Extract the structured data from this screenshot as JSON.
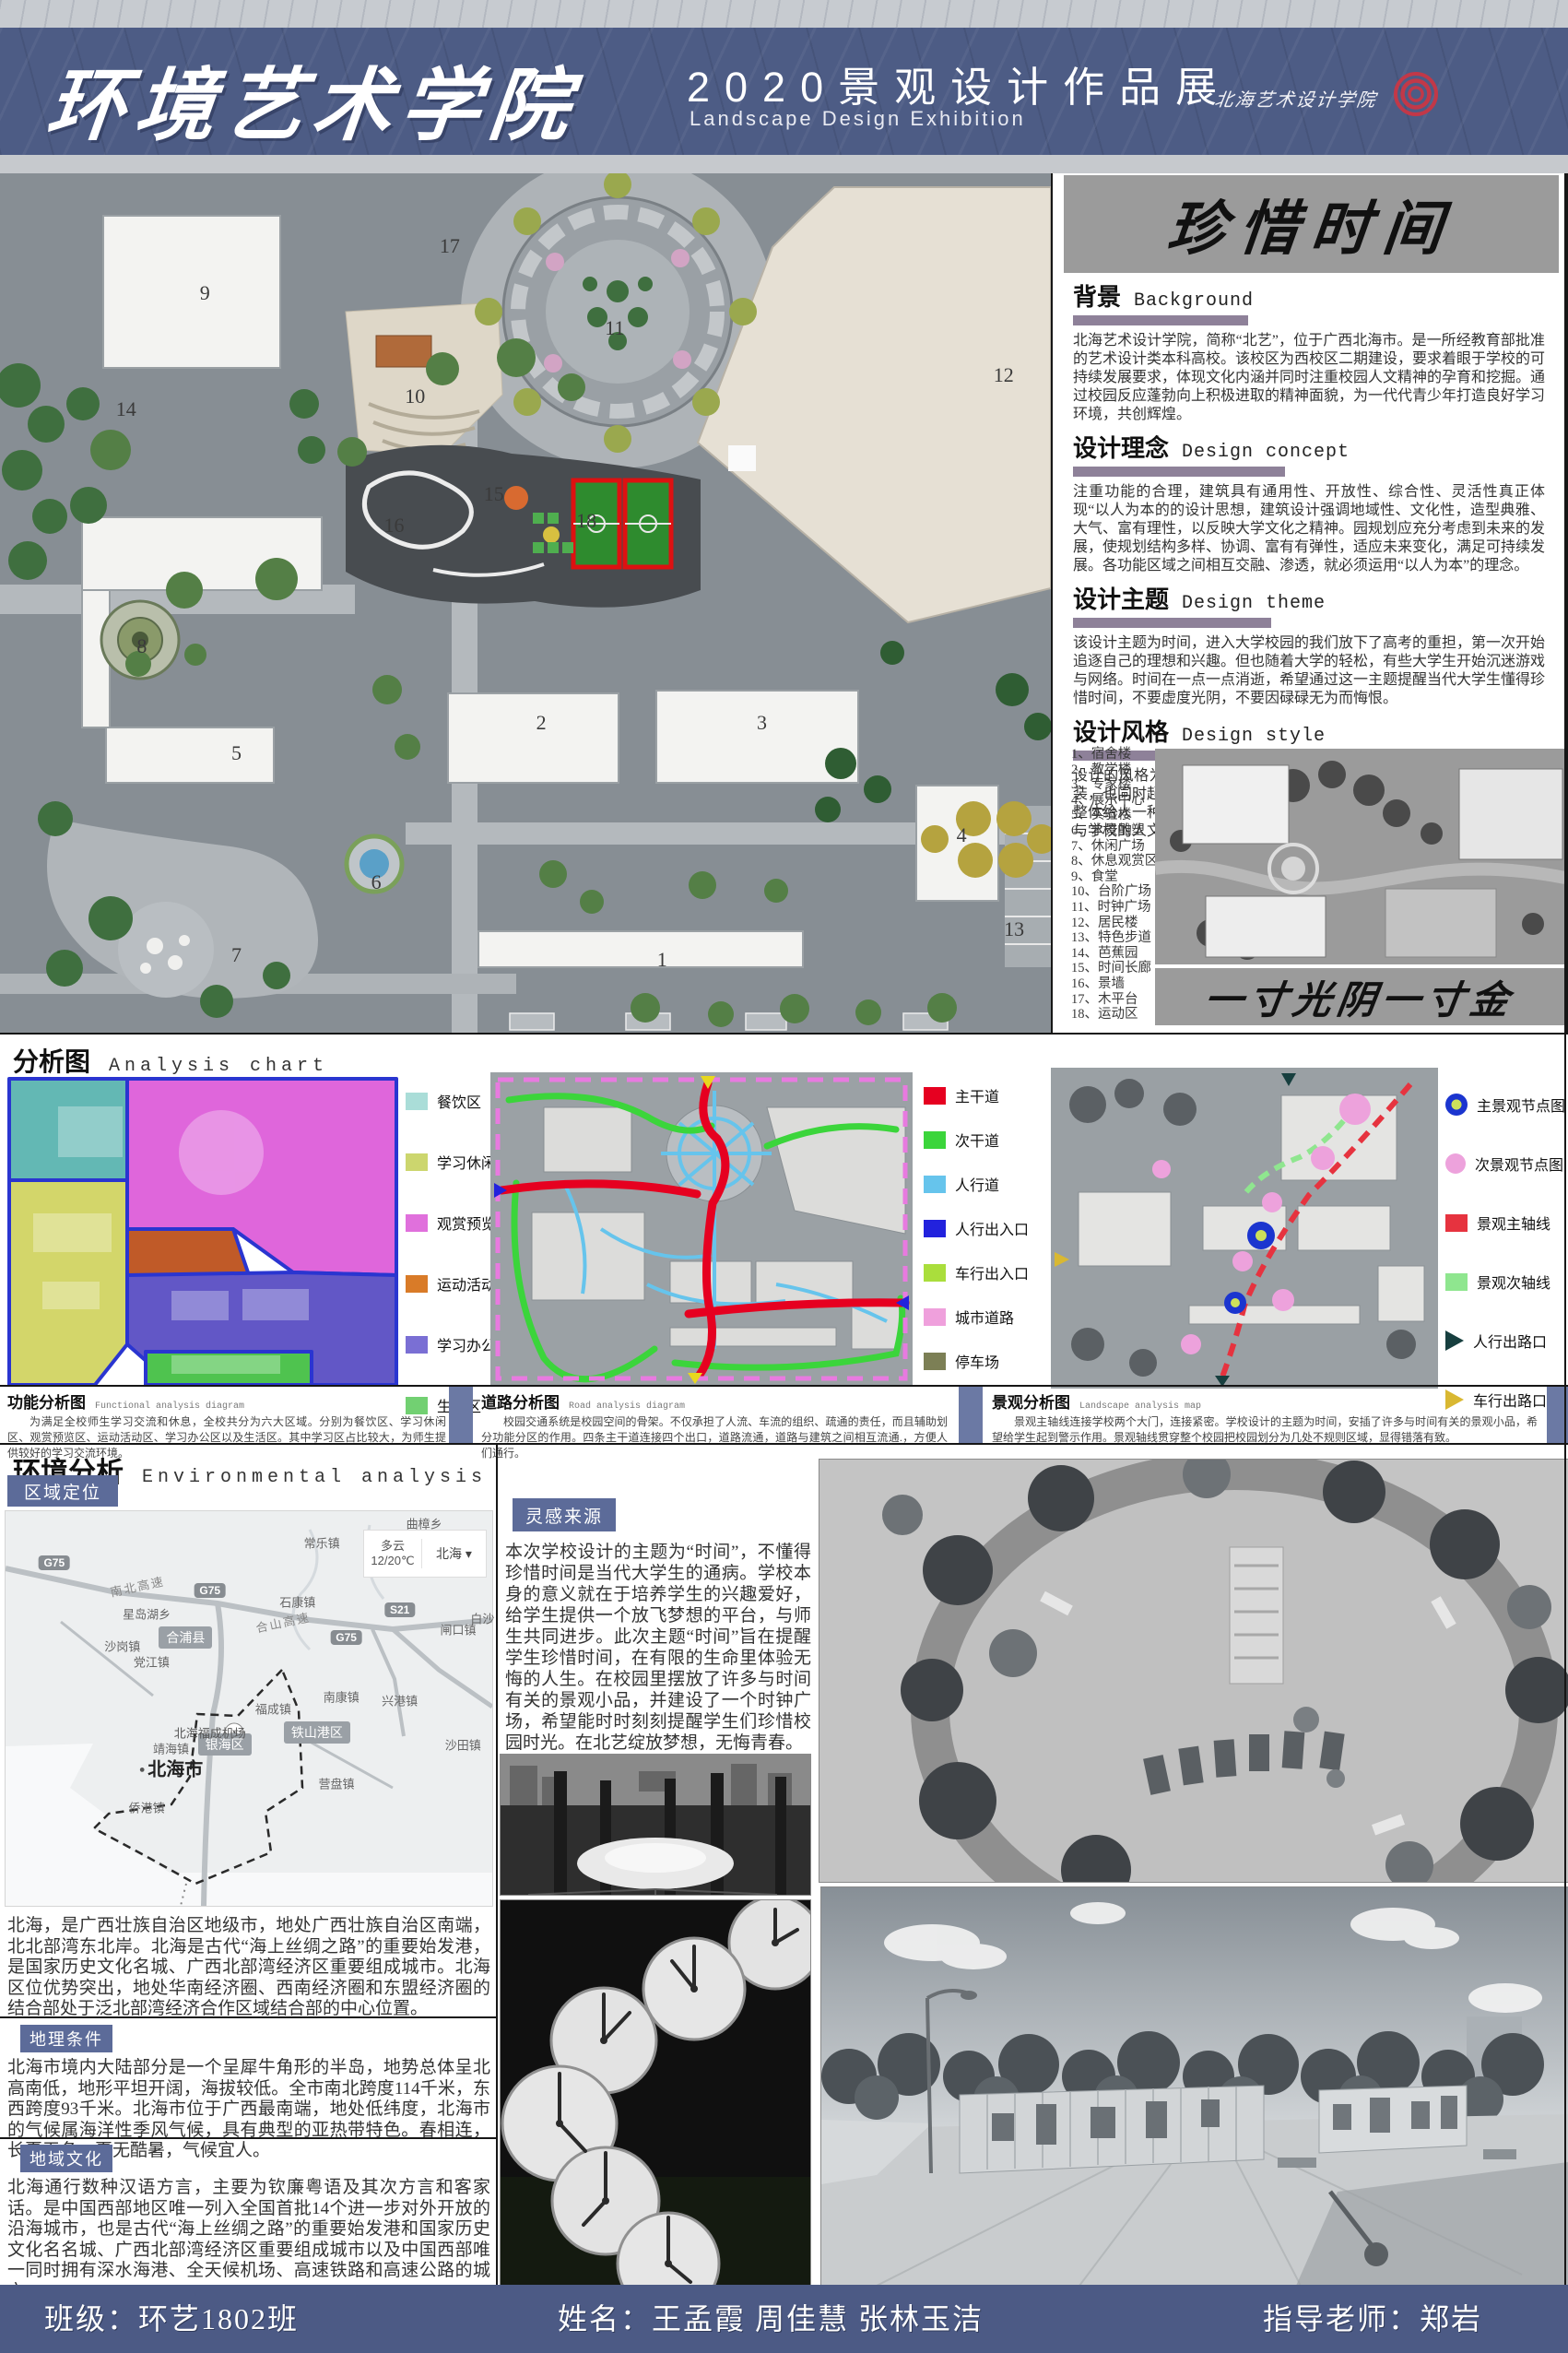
{
  "header": {
    "title_cn": "环境艺术学院",
    "subtitle_cn": "2020景观设计作品展",
    "subtitle_en": "Landscape Design Exhibition",
    "logo_text": "北海艺术设计学院"
  },
  "masterplan": {
    "numbers": [
      {
        "n": "1",
        "x": 63,
        "y": 91.5
      },
      {
        "n": "2",
        "x": 51.5,
        "y": 64
      },
      {
        "n": "3",
        "x": 72.5,
        "y": 64
      },
      {
        "n": "4",
        "x": 91.5,
        "y": 77
      },
      {
        "n": "5",
        "x": 22.5,
        "y": 67.5
      },
      {
        "n": "6",
        "x": 35.8,
        "y": 82.5
      },
      {
        "n": "7",
        "x": 22.5,
        "y": 91
      },
      {
        "n": "8",
        "x": 13.5,
        "y": 55
      },
      {
        "n": "9",
        "x": 19.5,
        "y": 14
      },
      {
        "n": "10",
        "x": 39.5,
        "y": 26
      },
      {
        "n": "11",
        "x": 58.5,
        "y": 18
      },
      {
        "n": "12",
        "x": 95.5,
        "y": 23.5
      },
      {
        "n": "13",
        "x": 96.5,
        "y": 88
      },
      {
        "n": "14",
        "x": 12,
        "y": 27.5
      },
      {
        "n": "15",
        "x": 47,
        "y": 37.3
      },
      {
        "n": "16",
        "x": 37.5,
        "y": 41
      },
      {
        "n": "17",
        "x": 42.8,
        "y": 8.5
      },
      {
        "n": "18",
        "x": 55.8,
        "y": 40.5
      }
    ]
  },
  "right_panel": {
    "title": "珍惜时间",
    "sections": [
      {
        "title_cn": "背景",
        "title_en": "Background",
        "body": "北海艺术设计学院，简称“北艺”，位于广西北海市。是一所经教育部批准的艺术设计类本科高校。该校区为西校区二期建设，要求着眼于学校的可持续发展要求，体现文化内涵并同时注重校园人文精神的孕育和挖掘。通过校园反应蓬勃向上积极进取的精神面貌，为一代代青少年打造良好学习环境，共创辉煌。"
      },
      {
        "title_cn": "设计理念",
        "title_en": "Design concept",
        "body": "注重功能的合理，建筑具有通用性、开放性、综合性、灵活性真正体现“以人为本的的设计思想，建筑设计强调地域性、文化性，造型典雅、大气、富有理性，以反映大学文化之精神。园规划应充分考虑到未来的发展，使规划结构多样、协调、富有有弹性，适应未来变化，满足可持续发展。各功能区域之间相互交融、渗透，就必须运用“以人为本”的理念。"
      },
      {
        "title_cn": "设计主题",
        "title_en": "Design theme",
        "body": "该设计主题为时间，进入大学校园的我们放下了高考的重担，第一次开始追逐自己的理想和兴趣。但也随着大学的轻松，有些大学生开始沉迷游戏与网络。时间在一点一点消逝，希望通过这一主题提醒当代大学生懂得珍惜时间，不要虚度光阴，不要因碌碌无为而悔恨。"
      },
      {
        "title_cn": "设计风格",
        "title_en": "Design style",
        "body": "设计的风格为现代简约风格，在道路以及铺装上运用简单的图案进行铺装，也同时起到了分区的效果。建筑与道路和绿地相互呼应、紧密联系。整体给人一种简洁大方的感觉。景观小品也多采用现代简洁的风格，同时与学校的人文精神相呼应，整体的建筑与周边环境相呼应。"
      }
    ],
    "building_list": [
      "1、宿舍楼",
      "2、教学楼",
      "3、专家楼",
      "4、展示中心",
      "5、实验楼",
      "6、水景雕塑",
      "7、休闲广场",
      "8、休息观赏区",
      "9、食堂",
      "10、台阶广场",
      "11、时钟广场",
      "12、居民楼",
      "13、特色步道",
      "14、芭蕉园",
      "15、时间长廊",
      "16、景墙",
      "17、木平台",
      "18、运动区"
    ],
    "banner": "一寸光阴一寸金"
  },
  "analysis": {
    "title_cn": "分析图",
    "title_en": "Analysis chart",
    "functional_legend": [
      {
        "label": "餐饮区",
        "color": "#aaddd8"
      },
      {
        "label": "学习休闲区",
        "color": "#ccd66e"
      },
      {
        "label": "观赏预览区",
        "color": "#e070dc"
      },
      {
        "label": "运动活动区",
        "color": "#d97b28"
      },
      {
        "label": "学习办公区",
        "color": "#7a6fd4"
      },
      {
        "label": "生活区",
        "color": "#72d072"
      }
    ],
    "road_legend": [
      {
        "label": "主干道",
        "color": "#e60020"
      },
      {
        "label": "次干道",
        "color": "#3bd53b"
      },
      {
        "label": "人行道",
        "color": "#66c4ec"
      },
      {
        "label": "人行出入口",
        "color": "#2222dd"
      },
      {
        "label": "车行出入口",
        "color": "#aade3c"
      },
      {
        "label": "城市道路",
        "color": "#efa0dc"
      },
      {
        "label": "停车场",
        "color": "#7c7f55"
      }
    ],
    "landscape_legend": [
      {
        "label": "主景观节点图",
        "shape": "donut",
        "color": "#1b35cf"
      },
      {
        "label": "次景观节点图",
        "shape": "circle",
        "color": "#eda2dc"
      },
      {
        "label": "景观主轴线",
        "shape": "square",
        "color": "#e6333f"
      },
      {
        "label": "景观次轴线",
        "shape": "square",
        "color": "#8fe68f"
      },
      {
        "label": "人行出路口",
        "shape": "triangle",
        "color": "#173f3f"
      },
      {
        "label": "车行出路口",
        "shape": "triangle",
        "color": "#d9b832"
      }
    ],
    "captions": [
      {
        "title_cn": "功能分析图",
        "title_en": "Functional analysis diagram",
        "body": "为满足全校师生学习交流和休息，全校共分为六大区域。分别为餐饮区、学习休闲区、观赏预览区、运动活动区、学习办公区以及生活区。其中学习区占比较大，为师生提供较好的学习交流环境。"
      },
      {
        "title_cn": "道路分析图",
        "title_en": "Road analysis diagram",
        "body": "校园交通系统是校园空间的骨架。不仅承担了人流、车流的组织、疏通的责任，而且辅助划分功能分区的作用。四条主干道连接四个出口，道路流通，道路与建筑之间相互流通.，方便人们通行。"
      },
      {
        "title_cn": "景观分析图",
        "title_en": "Landscape analysis map",
        "body": "景观主轴线连接学校两个大门，连接紧密。学校设计的主题为时间，安插了许多与时间有关的景观小品，希望给学生起到警示作用。景观轴线贯穿整个校园把校园划分为几处不规则区域，显得错落有致。"
      }
    ]
  },
  "environment": {
    "title_cn": "环境分析",
    "title_en": "Environmental analysis",
    "region_label": "区域定位",
    "inspiration_label": "灵感来源",
    "geo_label": "地理条件",
    "culture_label": "地域文化",
    "intro": "北海，是广西壮族自治区地级市，地处广西壮族自治区南端，北北部湾东北岸。北海是古代“海上丝绸之路”的重要始发港，是国家历史文化名城、广西北部湾经济区重要组成城市。北海区位优势突出，地处华南经济圈、西南经济圈和东盟经济圈的结合部处于泛北部湾经济合作区域结合部的中心位置。",
    "geo_body": "北海市境内大陆部分是一个呈犀牛角形的半岛，地势总体呈北高南低，地形平坦开阔，海拔较低。全市南北跨度114千米，东西跨度93千米。北海市位于广西最南端，地处低纬度，北海市的气候属海洋性季风气候，具有典型的亚热带特色。春相连，长夏无冬，夏无酷暑，气候宜人。",
    "culture_body": "北海通行数种汉语方言，主要为钦廉粤语及其次方言和客家话。是中国西部地区唯一列入全国首批14个进一步对外开放的沿海城市，也是古代“海上丝绸之路”的重要始发港和国家历史文化名名城、广西北部湾经济区重要组成城市以及中国西部唯一同时拥有深水海港、全天候机场、高速铁路和高速公路的城市。",
    "inspiration_body": "本次学校设计的主题为“时间”，不懂得珍惜时间是当代大学生的通病。学校本身的意义就在于培养学生的兴趣爱好，给学生提供一个放飞梦想的平台，与师生共同进步。此次主题“时间”旨在提醒学生珍惜时间，在有限的生命里体验无悔的人生。在校园里摆放了许多与时间有关的景观小品，并建设了一个时钟广场，希望能时时刻刻提醒学生们珍惜校园时光。在北艺绽放梦想，无悔青春。",
    "map": {
      "weather_condition": "多云",
      "weather_temp": "12/20℃",
      "weather_city": "北海",
      "city_label": "北海市",
      "airport_label": "北海福成机场",
      "places": [
        {
          "label": "曲樟乡",
          "t": "town",
          "x": 86,
          "y": 3
        },
        {
          "label": "常乐镇",
          "t": "town",
          "x": 65,
          "y": 8
        },
        {
          "label": "南北高速",
          "t": "roadname",
          "x": 27,
          "y": 19
        },
        {
          "label": "石康镇",
          "t": "town",
          "x": 60,
          "y": 23
        },
        {
          "label": "合山高速",
          "t": "roadname",
          "x": 57,
          "y": 28
        },
        {
          "label": "G75",
          "t": "badge",
          "x": 10,
          "y": 13
        },
        {
          "label": "G75",
          "t": "badge",
          "x": 42,
          "y": 20
        },
        {
          "label": "G75",
          "t": "badge",
          "x": 70,
          "y": 32
        },
        {
          "label": "S21",
          "t": "badge",
          "x": 81,
          "y": 25
        },
        {
          "label": "闸口镇",
          "t": "town",
          "x": 93,
          "y": 30
        },
        {
          "label": "白沙",
          "t": "town",
          "x": 98,
          "y": 27
        },
        {
          "label": "星岛湖乡",
          "t": "town",
          "x": 29,
          "y": 26
        },
        {
          "label": "沙岗镇",
          "t": "town",
          "x": 24,
          "y": 34
        },
        {
          "label": "合浦县",
          "t": "area",
          "x": 37,
          "y": 32
        },
        {
          "label": "党江镇",
          "t": "town",
          "x": 30,
          "y": 38
        },
        {
          "label": "南康镇",
          "t": "town",
          "x": 69,
          "y": 47
        },
        {
          "label": "兴港镇",
          "t": "town",
          "x": 81,
          "y": 48
        },
        {
          "label": "福成镇",
          "t": "town",
          "x": 55,
          "y": 50
        },
        {
          "label": "铁山港区",
          "t": "area",
          "x": 64,
          "y": 56
        },
        {
          "label": "银海区",
          "t": "area",
          "x": 45,
          "y": 59
        },
        {
          "label": "靖海镇",
          "t": "town",
          "x": 34,
          "y": 60
        },
        {
          "label": "沙田镇",
          "t": "town",
          "x": 94,
          "y": 59
        },
        {
          "label": "营盘镇",
          "t": "town",
          "x": 68,
          "y": 69
        },
        {
          "label": "侨港镇",
          "t": "town",
          "x": 29,
          "y": 75
        }
      ]
    }
  },
  "footer": {
    "class_text": "班级：环艺1802班",
    "names_text": "姓名：王孟霞 周佳慧 张林玉洁",
    "teacher_text": "指导老师：郑岩"
  }
}
